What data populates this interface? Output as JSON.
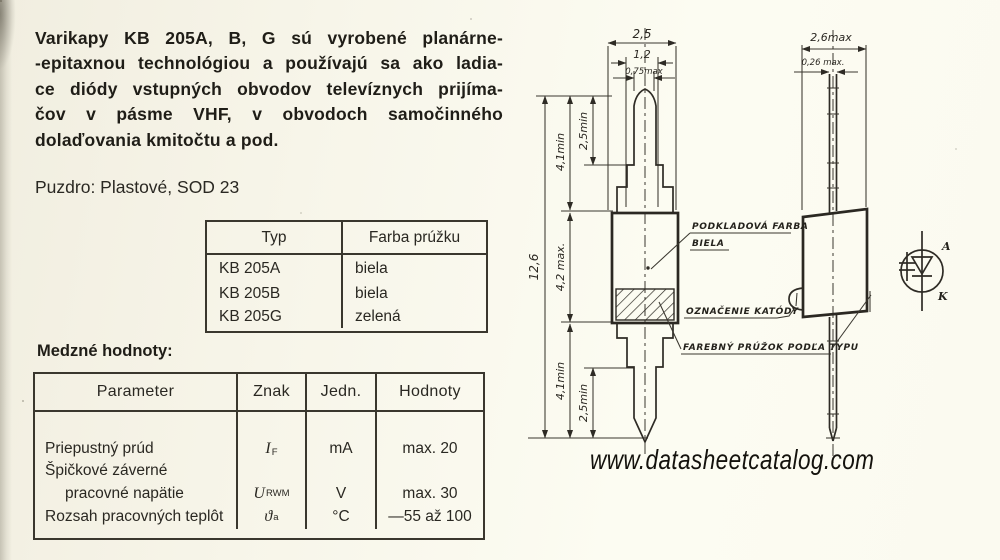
{
  "page": {
    "watermark": "www.datasheetcatalog.com"
  },
  "intro": {
    "lines": [
      "Varikapy KB 205A, B, G sú vyrobené planárne-",
      "-epitaxnou technológiou a používajú sa ako ladia-",
      "ce diódy vstupných obvodov televíznych prijíma-",
      "čov v pásme VHF, v obvodoch samočinného",
      "dolaďovania kmitočtu a pod."
    ]
  },
  "package_line": "Puzdro: Plastové, SOD 23",
  "type_table": {
    "headers": [
      "Typ",
      "Farba prúžku"
    ],
    "rows": [
      {
        "typ": "KB 205A",
        "farba": "biela"
      },
      {
        "typ": "KB 205B",
        "farba": "biela"
      },
      {
        "typ": "KB 205G",
        "farba": "zelená"
      }
    ]
  },
  "limits": {
    "title": "Medzné hodnoty:",
    "headers": [
      "Parameter",
      "Znak",
      "Jedn.",
      "Hodnoty"
    ],
    "rows": [
      {
        "parameter": "Priepustný prúd",
        "znak_main": "I",
        "znak_sub": "F",
        "unit": "mA",
        "value": "max. 20"
      },
      {
        "parameter": "Špičkové záverné",
        "parameter2": "pracovné napätie",
        "znak_main": "U",
        "znak_sub": "RWM",
        "unit": "V",
        "value": "max. 30"
      },
      {
        "parameter": "Rozsah pracovných teplôt",
        "znak_main": "ϑ",
        "znak_sub": "a",
        "unit": "°C",
        "value": "—55 až 100"
      }
    ]
  },
  "drawing": {
    "front_view": {
      "dims": {
        "body_width": "2,5",
        "lead_step_width": "1,2",
        "lead_tip_width": "0,75max",
        "overall_length": "12,6",
        "lead_top_length": "4,1min",
        "lead_top_tip": "2,5min",
        "body_length": "4,2 max.",
        "lead_bottom_length": "4,1min",
        "lead_bottom_tip": "2,5min"
      }
    },
    "side_view": {
      "dims": {
        "body_depth": "2,6max",
        "lead_thickness": "0,26 max."
      }
    },
    "labels": {
      "base_color_1": "PODKLADOVÁ FARBA",
      "base_color_2": "BIELA",
      "cathode_mark": "OZNAČENIE KATÓDY",
      "stripe": "FAREBNÝ PRÚŽOK PODĽA TYPU"
    },
    "symbol": {
      "anode": "A",
      "cathode": "K"
    }
  }
}
